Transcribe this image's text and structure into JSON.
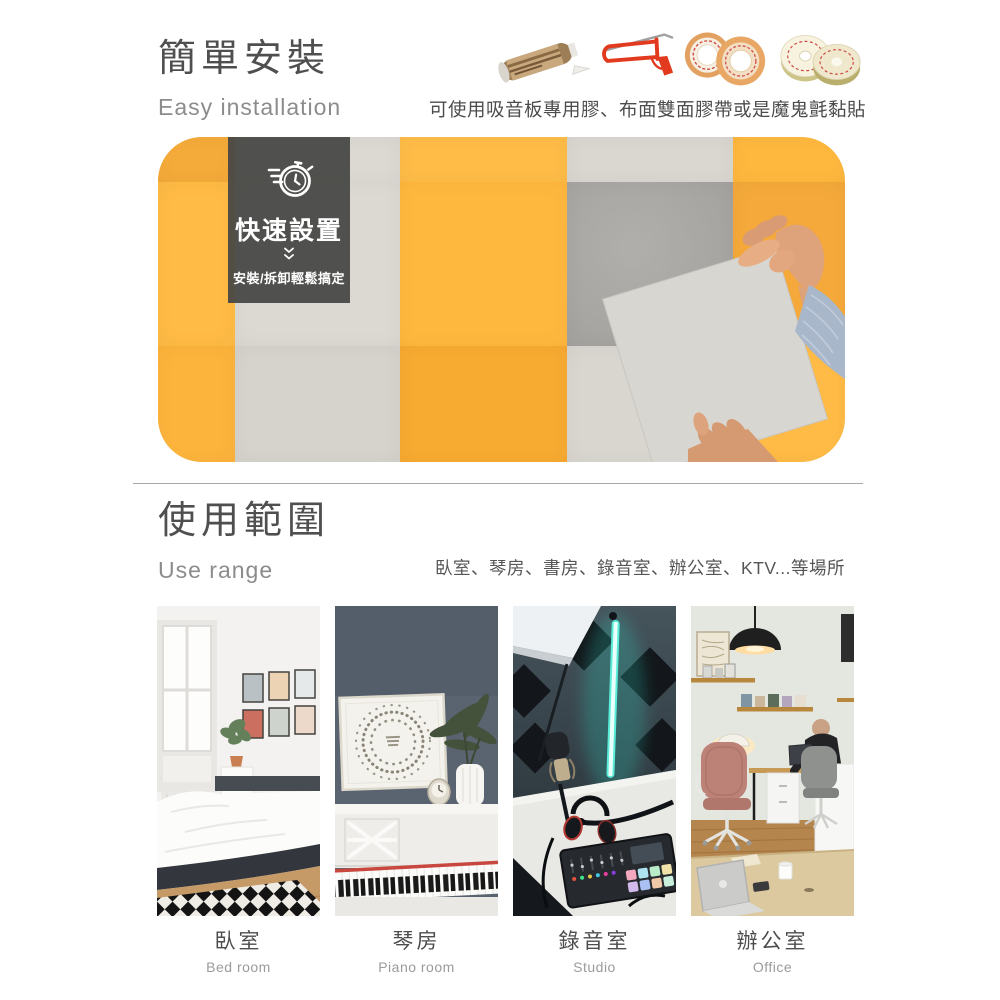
{
  "install": {
    "title": "簡單安裝",
    "subtitle": "Easy installation",
    "caption": "可使用吸音板專用膠、布面雙面膠帶或是魔鬼氈黏貼",
    "tools": [
      "adhesive-tube",
      "caulking-gun",
      "double-sided-tape-rolls",
      "velcro-rolls"
    ],
    "badge": {
      "title": "快速設置",
      "note": "安裝/拆卸輕鬆搞定"
    }
  },
  "range": {
    "title": "使用範圍",
    "subtitle": "Use range",
    "caption": "臥室、琴房、書房、錄音室、辦公室、KTV...等場所",
    "places": [
      {
        "zh": "臥室",
        "en": "Bed room"
      },
      {
        "zh": "琴房",
        "en": "Piano room"
      },
      {
        "zh": "錄音室",
        "en": "Studio"
      },
      {
        "zh": "辦公室",
        "en": "Office"
      }
    ]
  },
  "colors": {
    "accent_yellow": "#ffb83e",
    "panel_gray": "#d8d5cf",
    "concrete_gray": "#aaa8a4",
    "badge_bg": "#474745",
    "text_dark": "#4d4d4d",
    "text_muted": "#8c8c8c"
  }
}
